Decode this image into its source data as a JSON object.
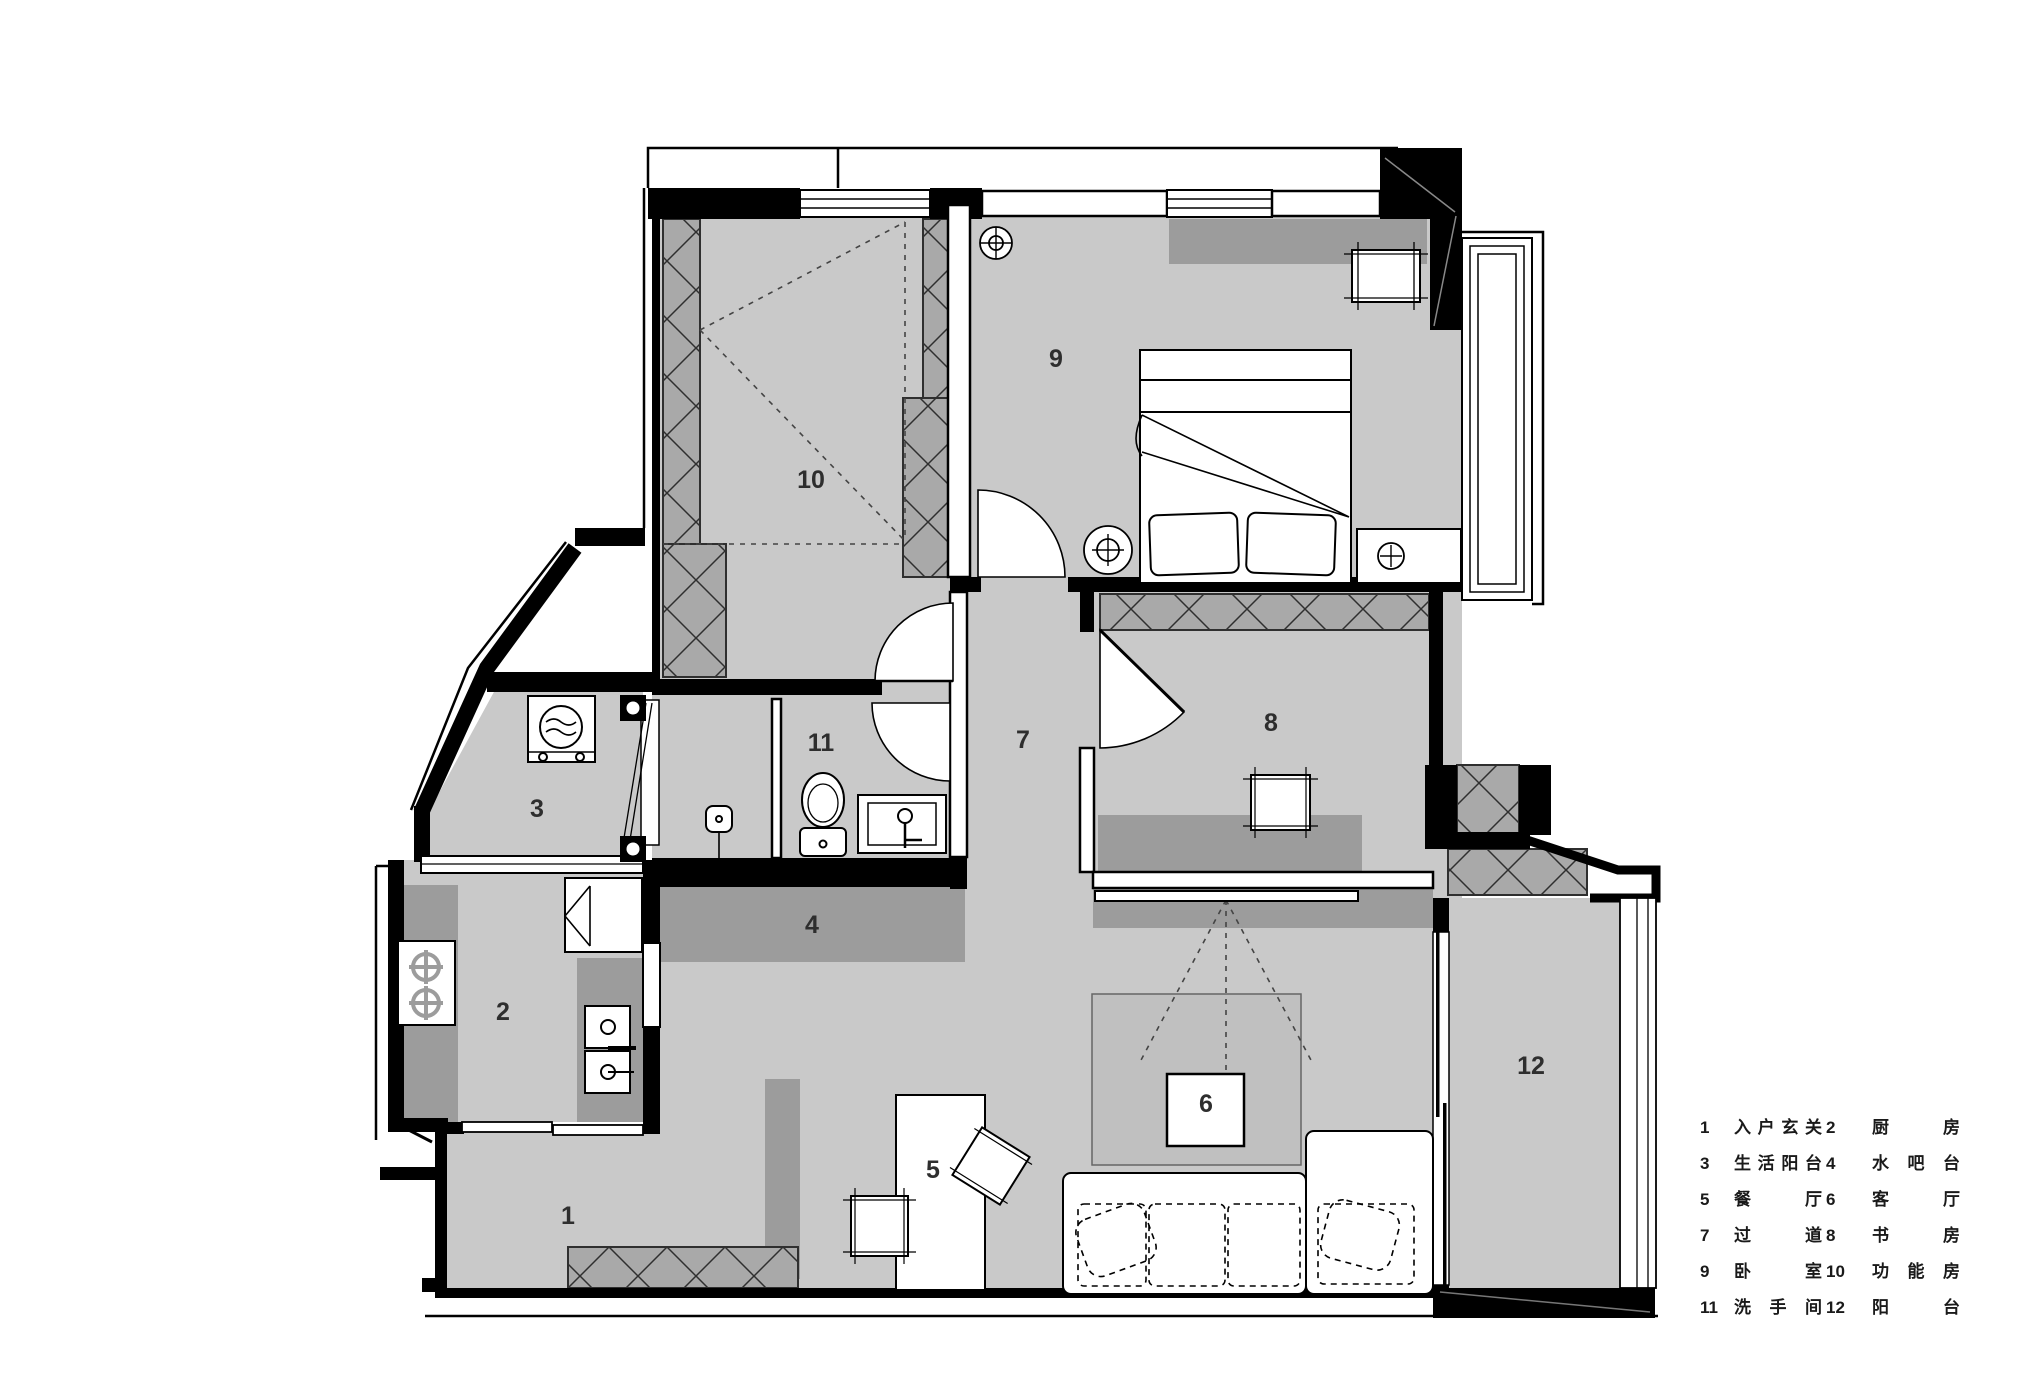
{
  "rooms": [
    {
      "number": "1",
      "name": "入户玄关"
    },
    {
      "number": "2",
      "name": "厨房"
    },
    {
      "number": "3",
      "name": "生活阳台"
    },
    {
      "number": "4",
      "name": "水吧台"
    },
    {
      "number": "5",
      "name": "餐厅"
    },
    {
      "number": "6",
      "name": "客厅"
    },
    {
      "number": "7",
      "name": "过道"
    },
    {
      "number": "8",
      "name": "书房"
    },
    {
      "number": "9",
      "name": "卧室"
    },
    {
      "number": "10",
      "name": "功能房"
    },
    {
      "number": "11",
      "name": "洗手间"
    },
    {
      "number": "12",
      "name": "阳台"
    }
  ],
  "colors": {
    "floor": "#c9c9c9",
    "furniture": "#9c9c9c",
    "hatch": "#a9a9a9",
    "rug": "#c0c0c0",
    "wall": "#000000",
    "text": "#2e2e2e"
  }
}
